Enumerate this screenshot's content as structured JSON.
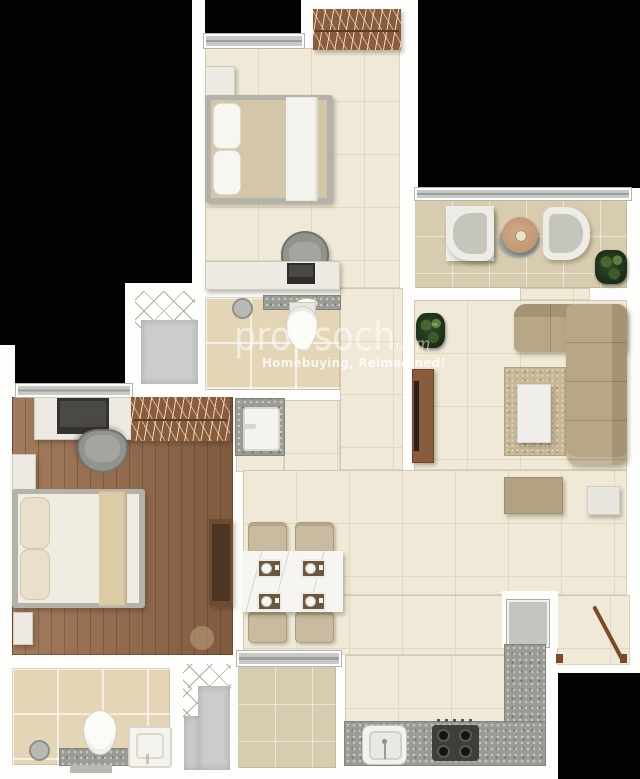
{
  "watermark": {
    "brand": "propsoch",
    "domain_script": "com",
    "trademark": "™",
    "tagline": "Homebuying, Reimagined!"
  },
  "palette": {
    "background": "#000000",
    "wall": "#fdfdfb",
    "floor_cream": "#f0e9d7",
    "floor_wood": "#996c4c",
    "floor_bath": "#e3d5b6",
    "floor_deck": "#d8ccb0",
    "counter_granite": "#9c9c96",
    "wardrobe_wood": "#8a5c3e",
    "sofa_fabric": "#b2a283",
    "door_wood": "#7b4a2d",
    "watermark_text": "rgba(255,255,255,0.6)"
  }
}
